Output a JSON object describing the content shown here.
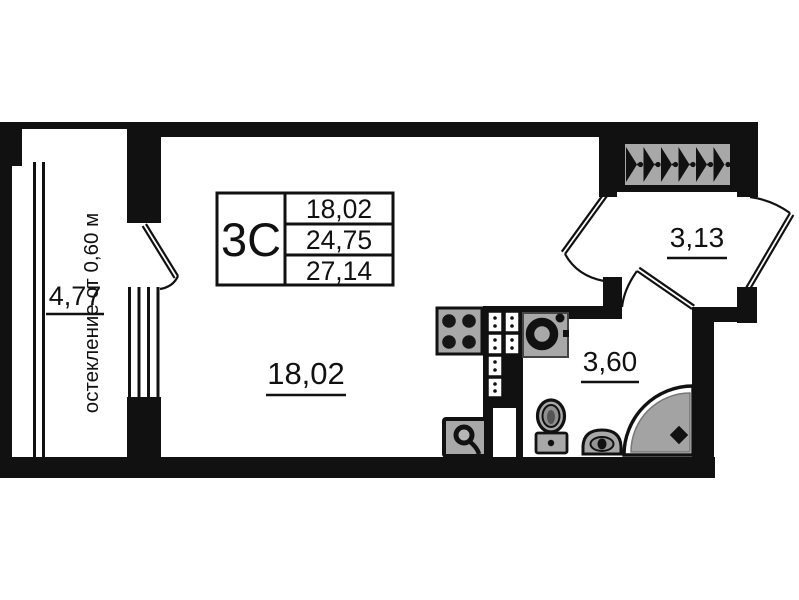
{
  "plan": {
    "info_table": {
      "type_label": "3С",
      "rows": [
        "18,02",
        "24,75",
        "27,14"
      ]
    },
    "rooms": {
      "living": {
        "area": "18,02"
      },
      "hall": {
        "area": "3,13"
      },
      "bathroom": {
        "area": "3,60"
      },
      "balcony": {
        "area": "4,77",
        "glazing_note": "остекление от 0,60 м"
      }
    },
    "colors": {
      "walls": "#111111",
      "fixture_fill": "#a8a8a8",
      "shower_fill": "#a3a3a3",
      "background": "#ffffff"
    },
    "icons": {
      "stove": "stove-4-burners",
      "kitchen_sink": "round-sink",
      "toilet": "toilet",
      "washbasin": "washbasin",
      "shower": "corner-shower",
      "washing_machine": "washing-machine",
      "vent_shaft": "ventilation-shaft-hatch",
      "vent_blocks": "ventilation-blocks"
    }
  }
}
